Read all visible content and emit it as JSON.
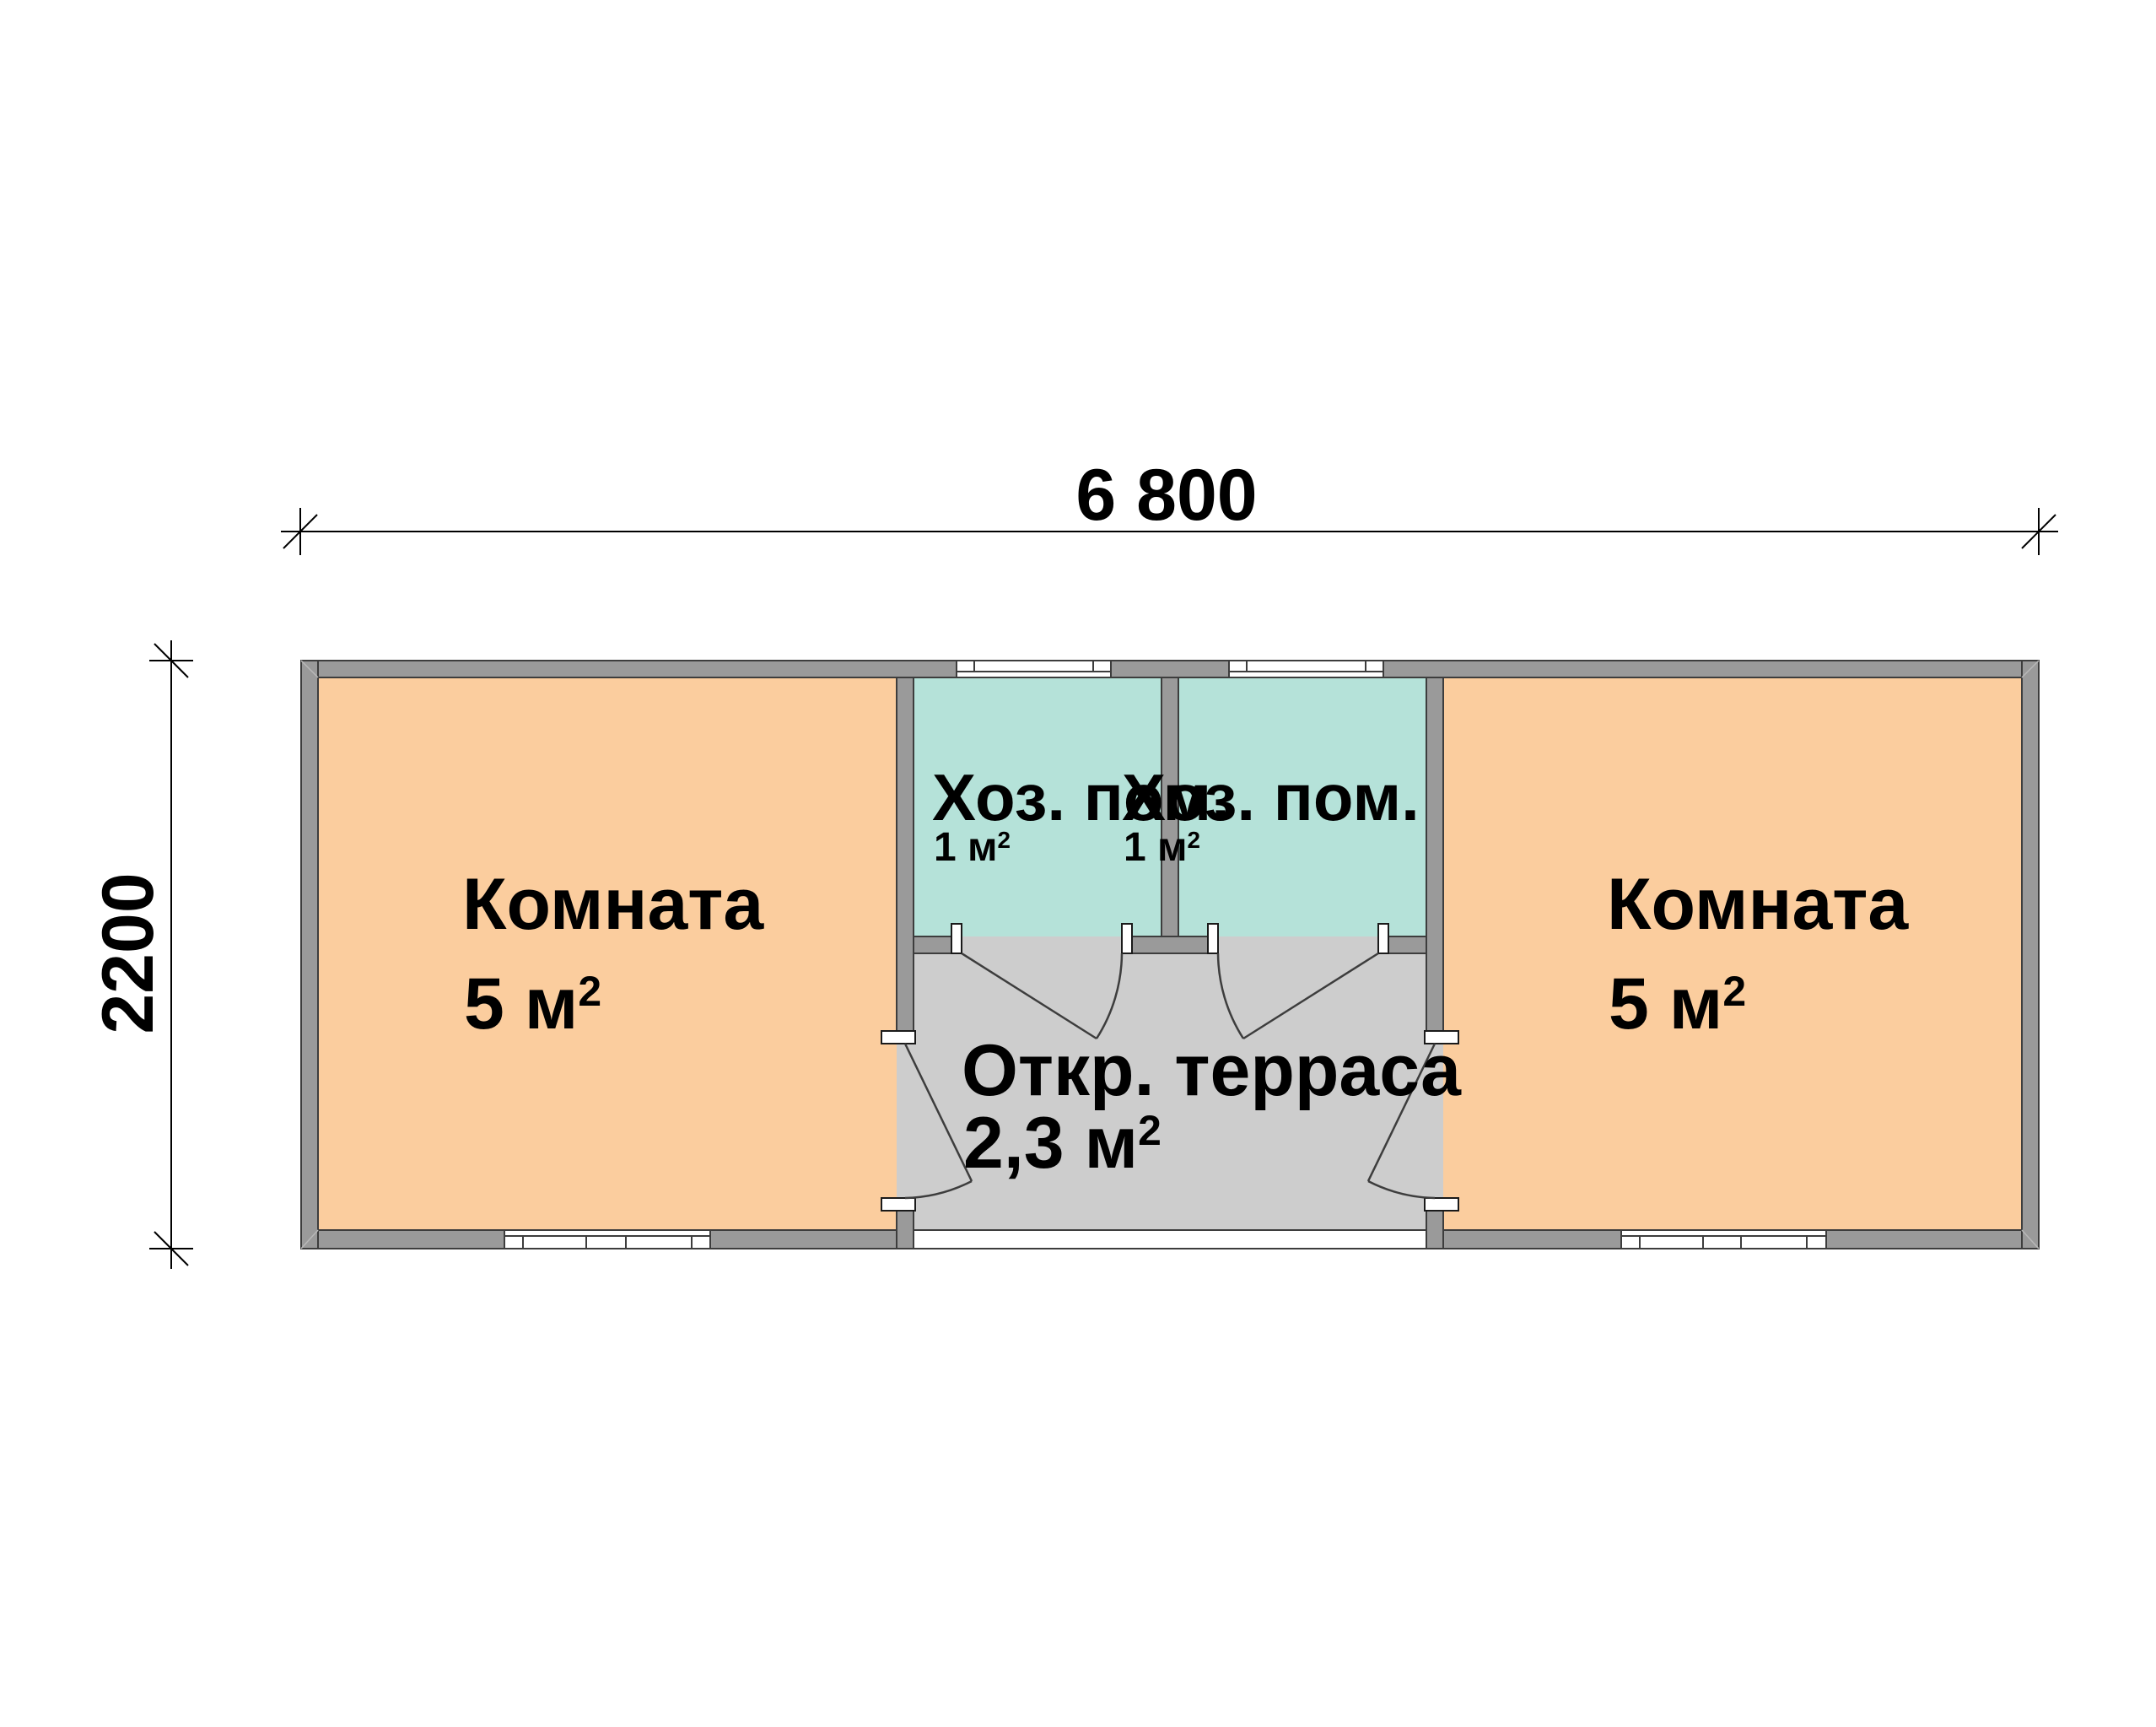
{
  "dimensions": {
    "width": "6 800",
    "height": "2200"
  },
  "rooms": {
    "room_left": {
      "name": "Комната",
      "area": "5 м",
      "area_sup": "2"
    },
    "room_right": {
      "name": "Комната",
      "area": "5 м",
      "area_sup": "2"
    },
    "utility_left": {
      "name": "Хоз. пом.",
      "area": "1 м",
      "area_sup": "2"
    },
    "utility_right": {
      "name": "Хоз. пом.",
      "area": "1 м",
      "area_sup": "2"
    },
    "terrace": {
      "name": "Откр. терраса",
      "area": "2,3 м",
      "area_sup": "2"
    }
  },
  "colors": {
    "room_fill": "#FBCD9E",
    "utility_fill": "#B5E2D9",
    "wall_fill": "#9A9A9A",
    "terrace_fill": "#CDCDCD",
    "outline": "#3D3D3D",
    "dimension": "#000000",
    "background": "#FFFFFF"
  }
}
